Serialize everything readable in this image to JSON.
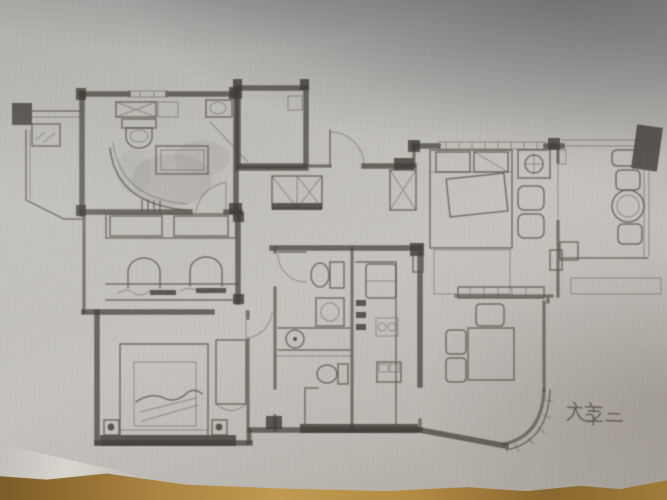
{
  "annotation": {
    "text": "方案二"
  },
  "palette": {
    "paper": "#c0beba",
    "paper_shadow": "#59595d",
    "pencil": "#56514a",
    "wall": "#443f39",
    "wood_table": "#b08b4a",
    "fold_highlight": "#eae7e0"
  },
  "scene_surfaces": [
    "paper-sheet",
    "wooden-table-edge"
  ],
  "plan": {
    "type": "hand-drawn-floor-plan",
    "rooms": [
      {
        "name": "ensuite-bathroom",
        "furniture": [
          "shower-box",
          "vanity-sink",
          "toilet",
          "bathtub",
          "curved-shower-screen"
        ]
      },
      {
        "name": "light-well",
        "furniture": []
      },
      {
        "name": "entry-hall",
        "furniture": [
          "entry-door",
          "closet",
          "closet"
        ]
      },
      {
        "name": "living-room",
        "furniture": [
          "console-table"
        ]
      },
      {
        "name": "master-bedroom",
        "furniture": [
          "double-bed",
          "pillows",
          "lamp-table",
          "armchair",
          "armchair",
          "foot-bench"
        ]
      },
      {
        "name": "balcony",
        "furniture": [
          "chair",
          "chair",
          "round-table",
          "chair",
          "ac-ledge"
        ]
      },
      {
        "name": "study",
        "furniture": [
          "bookshelf",
          "long-desk",
          "chair",
          "chair"
        ]
      },
      {
        "name": "second-bedroom",
        "furniture": [
          "bed",
          "nightstand",
          "nightstand",
          "wardrobe",
          "bay-window-sill"
        ]
      },
      {
        "name": "bathroom",
        "furniture": [
          "door",
          "toilet",
          "washing-machine",
          "sink-counter"
        ]
      },
      {
        "name": "second-bathroom",
        "furniture": [
          "toilet",
          "shower-stall"
        ]
      },
      {
        "name": "kitchen",
        "furniture": [
          "counter",
          "fridge",
          "double-sink",
          "stove"
        ]
      },
      {
        "name": "dining-area",
        "furniture": [
          "dining-table",
          "chair",
          "chair",
          "chair",
          "curved-wall"
        ]
      }
    ]
  }
}
